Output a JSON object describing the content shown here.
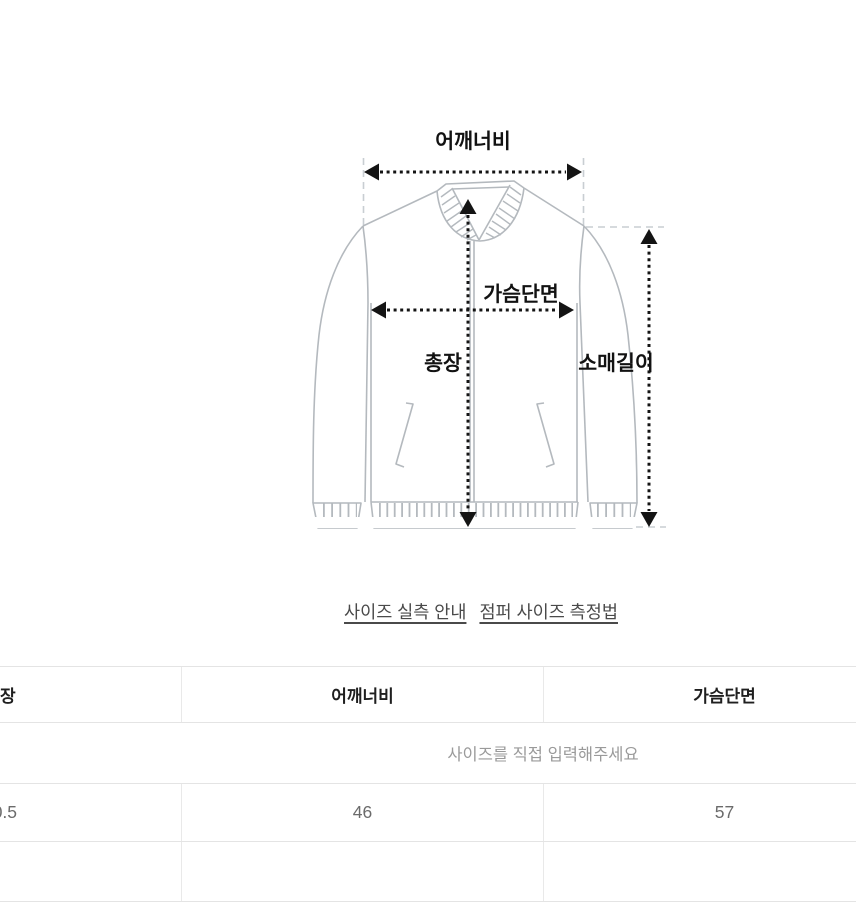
{
  "diagram": {
    "labels": {
      "shoulder_width": "어깨너비",
      "chest_width": "가슴단면",
      "total_length": "총장",
      "sleeve_length": "소매길이"
    }
  },
  "links": {
    "size_guide": "사이즈 실측 안내",
    "measure_method": "점퍼 사이즈 측정법"
  },
  "size_table": {
    "columns": [
      "총장",
      "어깨너비",
      "가슴단면",
      ""
    ],
    "input_prompt": "사이즈를 직접 입력해주세요",
    "rows": [
      [
        "70.5",
        "46",
        "57",
        ""
      ],
      [
        "",
        "",
        "",
        ""
      ]
    ]
  },
  "colors": {
    "jacket_outline": "#b4b9be",
    "arrow": "#141414",
    "guide_dash": "#c9ced2",
    "table_border": "#e4e4e4",
    "muted_text": "#9a9a9a",
    "link_text": "#4a4a4a"
  }
}
